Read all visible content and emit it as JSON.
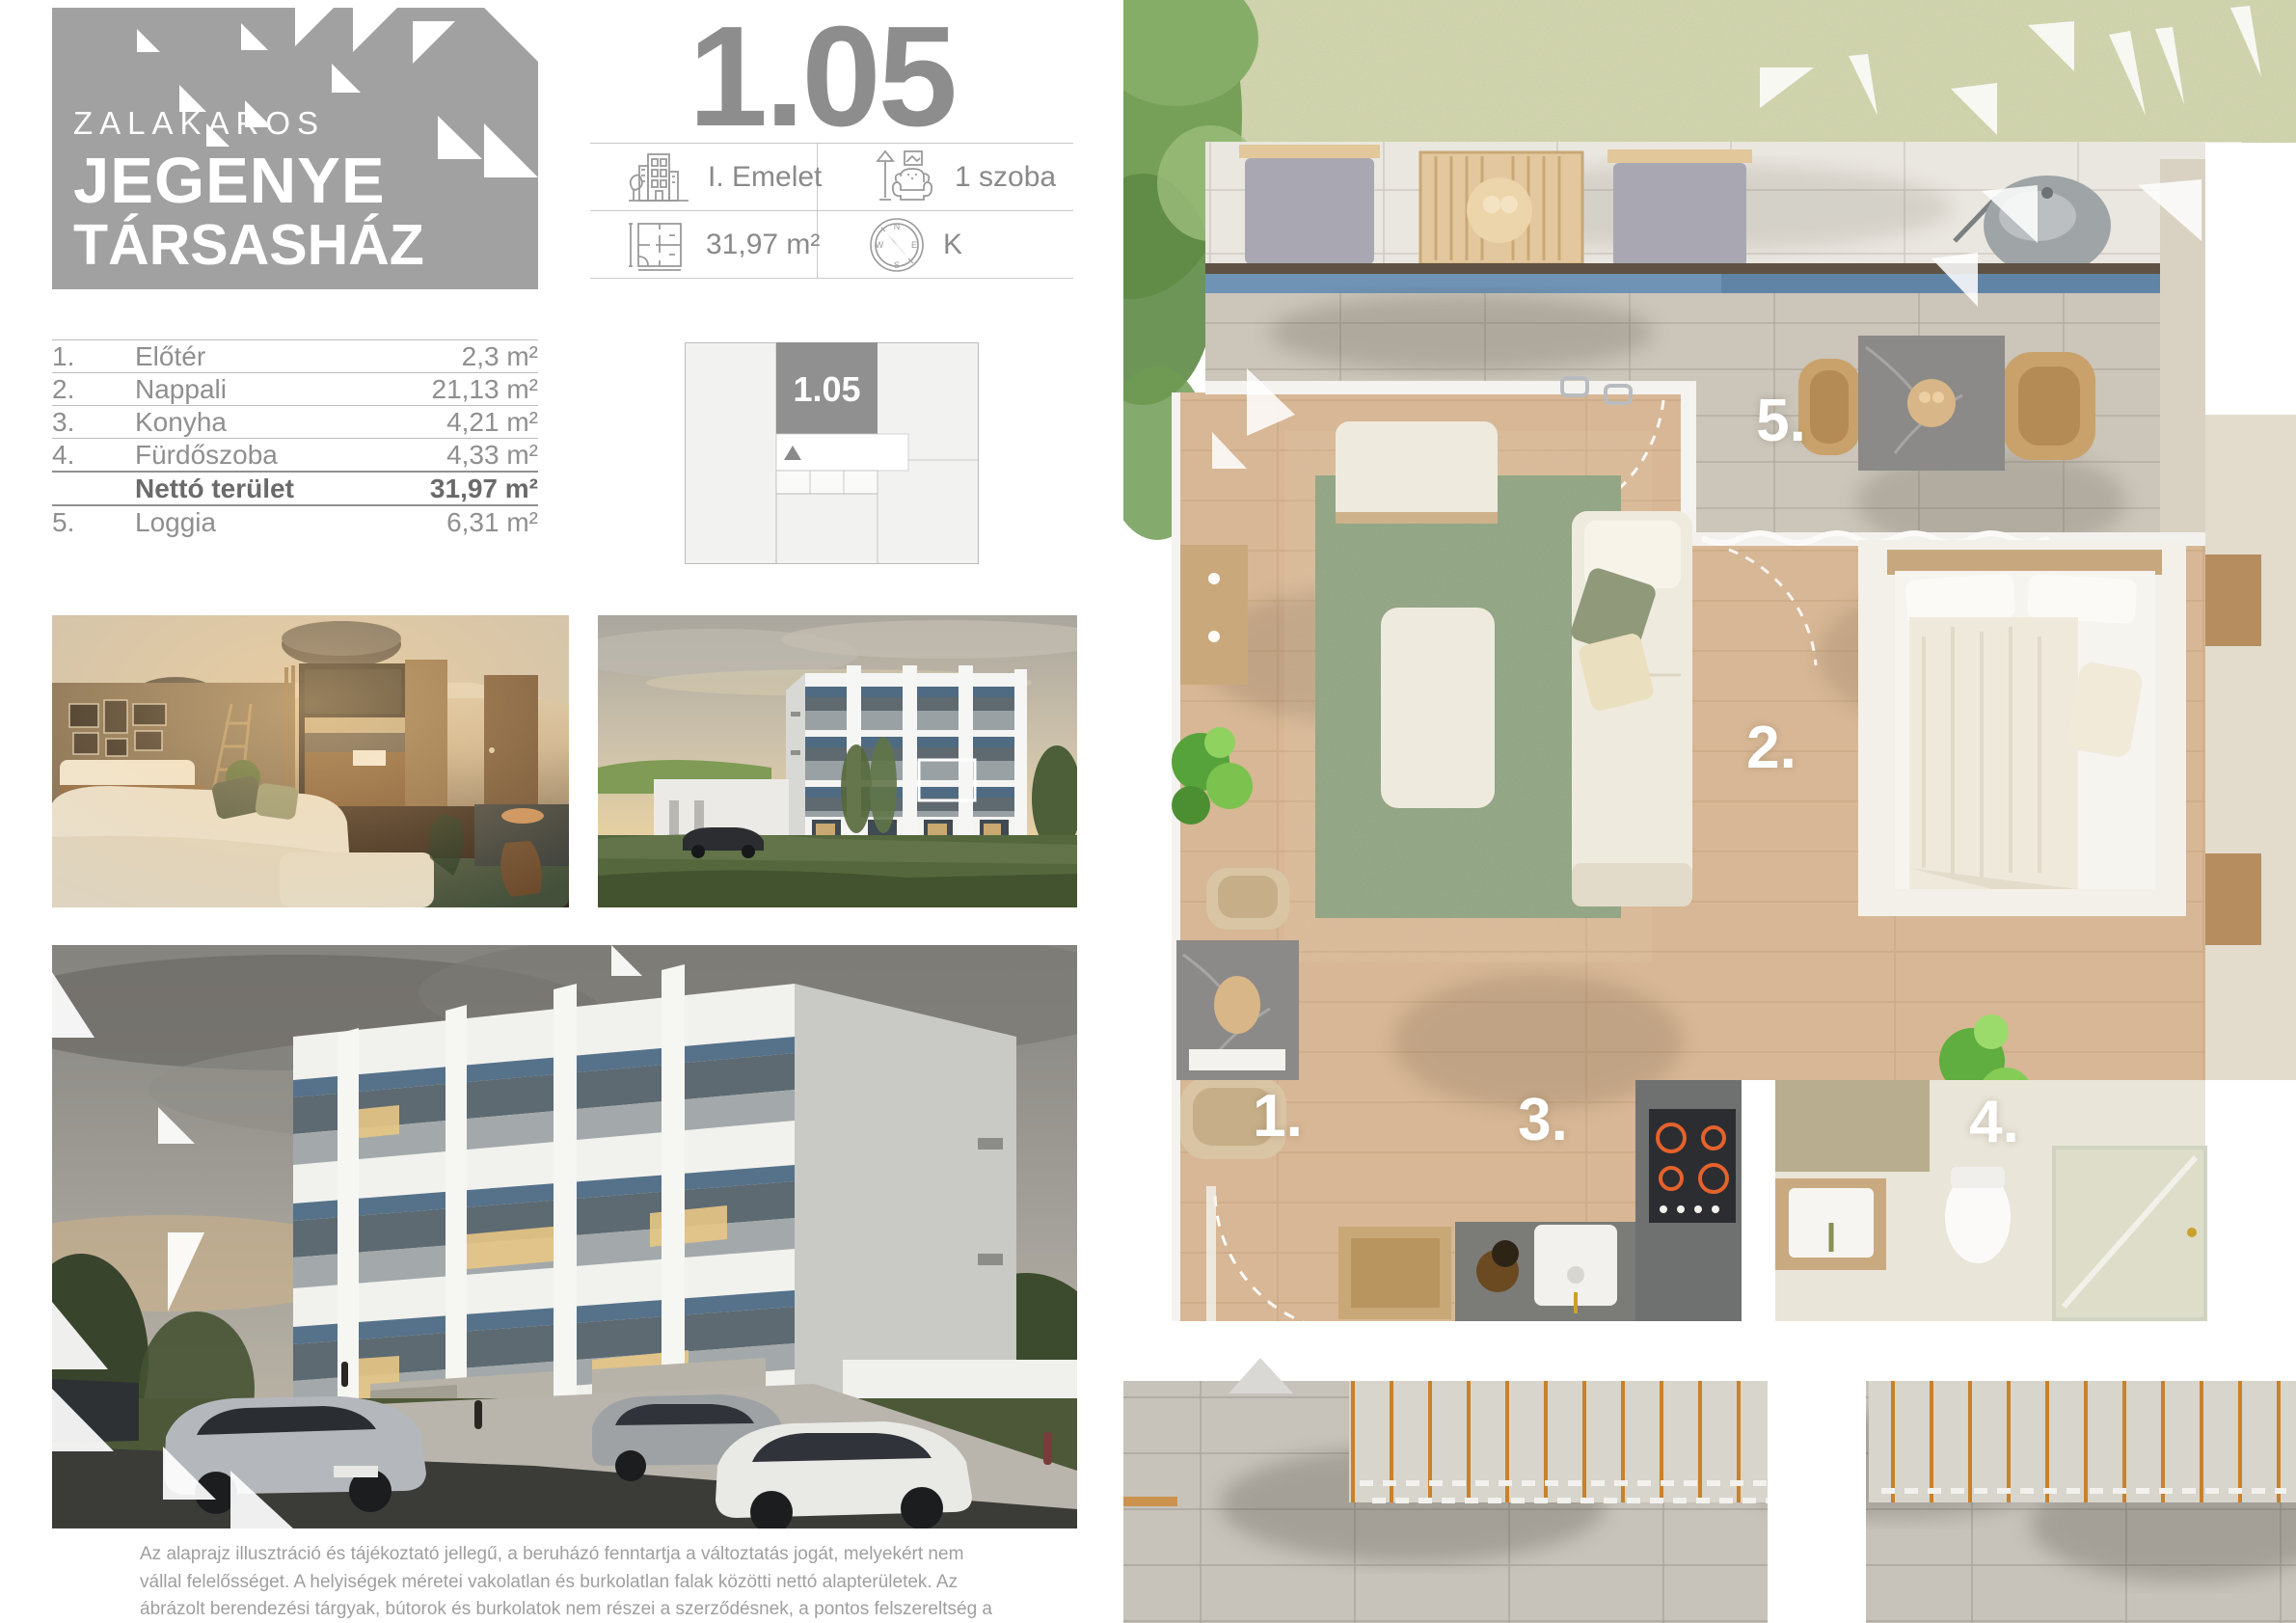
{
  "brand": {
    "city": "ZALAKAROS",
    "name_line1": "JEGENYE",
    "name_line2": "TÁRSASHÁZ"
  },
  "unit": {
    "number": "1.05",
    "floor": "I. Emelet",
    "rooms": "1 szoba",
    "area": "31,97 m²",
    "orientation": "K",
    "compass": {
      "n": "N",
      "e": "E",
      "s": "S",
      "w": "W"
    }
  },
  "info_icons": {
    "floor": "building-icon",
    "rooms": "armchair-icon",
    "area": "floorplan-icon",
    "orientation": "compass-icon"
  },
  "room_table": {
    "rows": [
      {
        "num": "1.",
        "name": "Előtér",
        "area": "2,3 m²"
      },
      {
        "num": "2.",
        "name": "Nappali",
        "area": "21,13 m²"
      },
      {
        "num": "3.",
        "name": "Konyha",
        "area": "4,21 m²"
      },
      {
        "num": "4.",
        "name": "Fürdőszoba",
        "area": "4,33 m²"
      },
      {
        "num": "",
        "name": "Nettó terület",
        "area": "31,97 m²"
      },
      {
        "num": "5.",
        "name": "Loggia",
        "area": "6,31 m²"
      }
    ]
  },
  "plan": {
    "labels": [
      {
        "text": "1."
      },
      {
        "text": "2."
      },
      {
        "text": "3."
      },
      {
        "text": "4."
      },
      {
        "text": "5."
      }
    ]
  },
  "disclaimer": "Az alaprajz illusztráció és tájékoztató jellegű, a beruházó fenntartja a változtatás jogát, melyekért nem vállal felelősséget. A helyiségek méretei vakolatlan és burkolatlan falak közötti nettó alapterületek. Az ábrázolt berendezési tárgyak, bútorok és burkolatok nem részei a szerződésnek, a pontos felszereltség a műszaki leírásban található.",
  "colors": {
    "brand_gray": "#a1a1a1",
    "title_gray": "#8d8d8d",
    "text_gray": "#8a8a8a",
    "accent_blue": "#6e93b4",
    "grass_green": "#c9cda3",
    "wood_floor": "#d7b795",
    "rug_green": "#8da17f",
    "cooktop_orange": "#e4622d"
  }
}
